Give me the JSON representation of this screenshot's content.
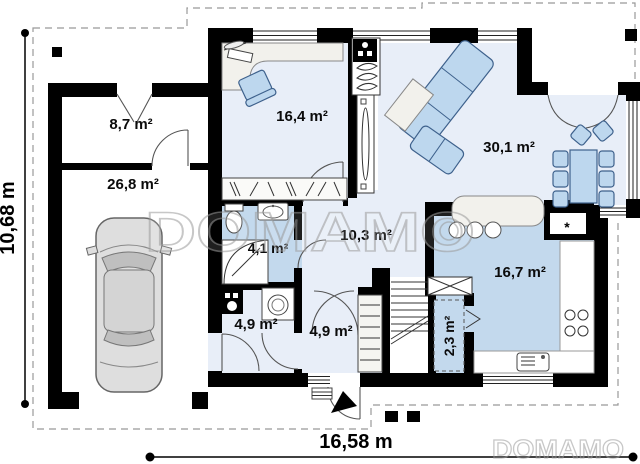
{
  "plan": {
    "watermark_main": "DOMAMO",
    "watermark_corner": "DOMAMO",
    "dimensions": {
      "bottom_width": "16,58 m",
      "left_height": "10,68 m"
    },
    "rooms": [
      {
        "name": "storage",
        "label": "8,7 m²"
      },
      {
        "name": "garage",
        "label": "26,8 m²"
      },
      {
        "name": "study",
        "label": "16,4 m²"
      },
      {
        "name": "living-room",
        "label": "30,1 m²"
      },
      {
        "name": "bathroom",
        "label": "4,1 m²"
      },
      {
        "name": "hall",
        "label": "10,3 m²"
      },
      {
        "name": "utility",
        "label": "4,9 m²"
      },
      {
        "name": "entry",
        "label": "4,9 m²"
      },
      {
        "name": "kitchen",
        "label": "16,7 m²"
      },
      {
        "name": "pantry",
        "label": "2,3 m²"
      }
    ],
    "symbols": {
      "fridge": "*"
    },
    "colors": {
      "floor_light": "#e8eef8",
      "floor_medium": "#c3d9ed",
      "wall": "#000000",
      "furniture_blue": "#bdd7ee"
    }
  }
}
